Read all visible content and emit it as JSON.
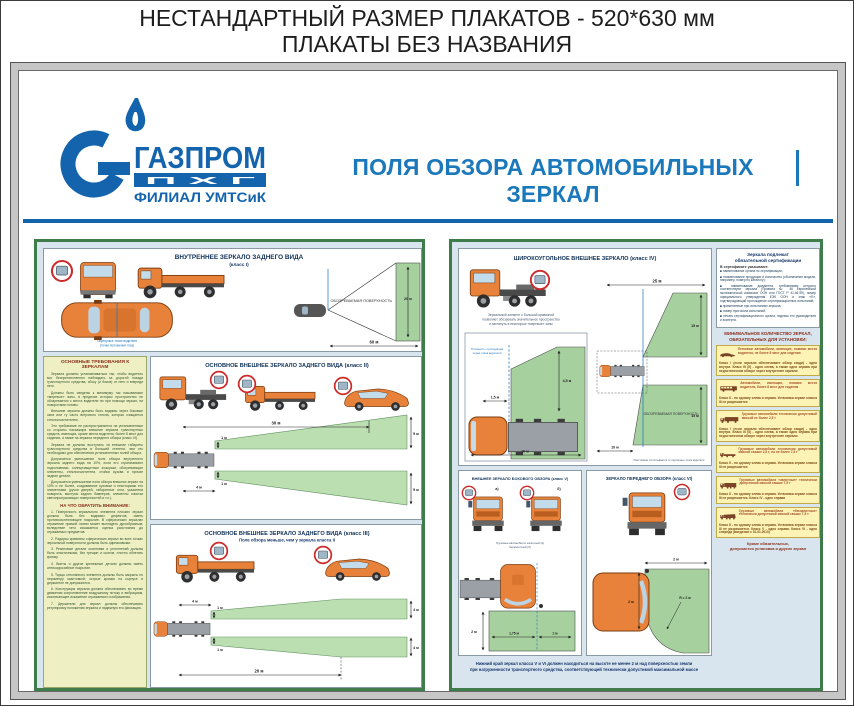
{
  "header": {
    "line1": "НЕСТАНДАРТНЫЙ РАЗМЕР ПЛАКАТОВ - 520*630 мм",
    "line2": "ПЛАКАТЫ БЕЗ НАЗВАНИЯ"
  },
  "brand": {
    "name": "ГАЗПРОМ",
    "unit": "П Х Г",
    "branch": "ФИЛИАЛ УМТСиК",
    "blue": "#1464ad"
  },
  "poster_title": "ПОЛЯ ОБЗОРА АВТОМОБИЛЬНЫХ ЗЕРКАЛ",
  "class1": {
    "title": "ВНУТРЕННЕЕ ЗЕРКАЛО ЗАДНЕГО ВИДА",
    "klass": "(класс I)",
    "surface": "ОБОЗРЕВАЕМАЯ ПОВЕРХНОСТЬ",
    "height_dim": "20 м",
    "width_dim": "60 м",
    "eye_note1": "Окулярные точки водителя",
    "eye_note2": "(точки положения глаз)"
  },
  "requirements": {
    "title": "ОСНОВНЫЕ ТРЕБОВАНИЯ К ЗЕРКАЛАМ",
    "paragraphs": [
      "Зеркала должны устанавливаться так, чтобы водитель мог беспрепятственно наблюдать за дорогой позади транспортного средства, сбоку (и боков) от него и впереди него.",
      "Должны быть сведены к минимуму так называемые «мертвые» зоны, в пределах которых пространство не обозревается с места водителя ни при помощи зеркал, ни поворотами головы.",
      "Внешние зеркала должны быть видимы через боковые окна или ту часть ветрового стекла, которая очищается стеклоочистителем.",
      "Это требование не распространяется на установленные со стороны пассажира внешние зеркала транспортных средств, имеющих, кроме места водителя, более 8 мест для сидения, а также на зеркала переднего обзора (класс VI).",
      "Зеркала не должны выступать за внешние габариты транспортного средства в большей степени, чем это необходимо для обеспечения установленных полей обзора.",
      "Допускается уменьшение поля обзора внутреннего зеркала заднего вида на 10%, если его ограничивают подголовники, солнцезащитные козырьки, обогревающие элементы, стеклоочистители, стойки кузова и прочие задние детали.",
      "Допускается уменьшение поля обзора внешних зеркал на 10% и не более, создаваемое кузовом и некоторыми его элементами (ручки дверей, габаритные огни, указатели поворота, выступы задних бамперов, элементы очистки светопропускающих поверхностей и т.п.)."
    ],
    "attention_title": "НА ЧТО ОБРАТИТЬ ВНИМАНИЕ:",
    "attention_items": [
      "1. Поверхность зеркального элемента плоских зеркал должна быть без видимых дефектов, иметь противоослепляющее покрытие. В сферических зеркалах отражение прямой линии может выглядеть дугообразным, вследствие чего искажается оценка расстояния до отражаемых предметов.",
      "2. Радиусы кривизны сферических зеркал во всех точках зеркальной поверхности должны быть одинаковыми.",
      "3. Резиновые детали окантовки и уплотнений должны быть эластичными, без трещин и сколов, плотно облегать кромку.",
      "4. Винты и другие крепежные детали должны иметь антикоррозийное покрытие.",
      "5. Торцы стеклянного элемента должны быть закрыты по периметру окантовкой; острые кромки на корпусе и держателе не допускаются.",
      "6. Конструкция зеркала должна обеспечивать во время движения сопротивление воздушному потоку и вибрациям, исключающее искажение отражаемого изображения.",
      "7. Держатели для зеркал должны обеспечивать регулировку положения зеркала и надежную его фиксацию."
    ]
  },
  "class2": {
    "title": "ОСНОВНОЕ ВНЕШНЕЕ ЗЕРКАЛО ЗАДНЕГО ВИДА (класс II)",
    "dims": {
      "length": "30 м",
      "far_top": "5 м",
      "far_bottom": "5 м",
      "near_top": "1 м",
      "near_bottom": "1 м",
      "offset": "4 м"
    }
  },
  "class3": {
    "title": "ОСНОВНОЕ ВНЕШНЕЕ ЗЕРКАЛО ЗАДНЕГО ВИДА (класс III)",
    "subtitle": "Поле обзора меньше, чем у зеркала класса II",
    "dims": {
      "offset": "4 м",
      "near_top": "1 м",
      "near_bottom": "1 м",
      "far_top": "4 м",
      "far_bottom": "4 м",
      "length": "20 м"
    }
  },
  "class4": {
    "title": "ШИРОКОУГОЛЬНОЕ ВНЕШНЕЕ ЗЕРКАЛО (класс IV)",
    "caption1": "Зеркальный элемент с большой кривизной",
    "caption2": "позволяет обозревать значительное пространство",
    "caption3": "и заглянуть в некоторые «мертвые» зоны",
    "inset": {
      "plane1": "Плоскость, проходящая",
      "plane2": "через глаза водителя",
      "h": "4,5 м",
      "w": "1,5 м",
      "len": "10 м"
    },
    "main": {
      "length": "25 м",
      "top": "15 м",
      "bottom": "15 м",
      "near": "10 м",
      "surface": "ОБОЗРЕВАЕМАЯ ПОВЕРХНОСТЬ",
      "note": "Расстояние отсчитывается от окулярных точек водителя"
    }
  },
  "class5": {
    "title": "ВНЕШНЕЕ ЗЕРКАЛО БОКОВОГО ОБЗОРА (класс V)",
    "label_a": "а)",
    "label_b": "б)",
    "caption1": "Грузовые автомобили: капотный (а)",
    "caption2": "бескапотный (б)",
    "dims": {
      "h": "2 м",
      "w1": "1,75 м",
      "w2": "1 м"
    }
  },
  "class6": {
    "title": "ЗЕРКАЛО ПЕРЕДНЕГО ОБЗОРА (класс VI)",
    "dims": {
      "front": "2 м",
      "h": "2 м",
      "r": "R = 2 м"
    }
  },
  "bottom_note1": "Нижний край зеркал класса V и VI должен находиться на высоте не менее 2 м над поверхностью земли",
  "bottom_note2": "при нагруженности транспортного средства, соответствующей технически допустимой максимальной массе",
  "certification": {
    "title1": "Зеркала подлежат",
    "title2": "обязательной сертификации",
    "intro": "В сертификате указывают:",
    "items": [
      "■ наименование органа по сертификации;",
      "■ наименование продукции и количество (обозначение модели, например, номер по каталогу);",
      "■ наименование документа, требованиям которого соответствуют зеркала (Правила № 46 Европейской экономической комиссии ООН или ГОСТ Р 41.46-99), номер официального утверждения ЕЭК ООН и знак «Е», подтверждающий прохождение сертификационных испытаний;",
      "■ примененные при испытаниях зеркала;",
      "■ номер протокола испытаний;",
      "■ печать сертификационного органа, подпись его руководителя и эксперта."
    ]
  },
  "minimum": {
    "title": "МИНИМАЛЬНОЕ КОЛИЧЕСТВО ЗЕРКАЛ, ОБЯЗАТЕЛЬНЫХ ДЛЯ УСТАНОВКИ:",
    "cards": [
      {
        "icon": "car-side-icon",
        "desc": "Легковые автомобили, имеющие, помимо места водителя, не более 8 мест для сидения",
        "classes": "Класс I (если зеркало обеспечивает обзор сзади) - одно внутри. Класс III (II) - одно слева, а также одно справа при недостаточном обзоре через внутреннее зеркало"
      },
      {
        "icon": "bus-side-icon",
        "desc": "Автомобили, имеющие, помимо места водителя, более 8 мест для сидения",
        "classes": "Класс II - по одному слева и справа. Установка зеркал класса III не разрешается"
      },
      {
        "icon": "light-truck-icon",
        "desc": "Грузовые автомобили технически допустимой массой не более 2,5 т",
        "classes": "Класс I (если зеркало обеспечивает обзор сзади) - одно внутри. Класс III (II) - одно слева, а также одно справа при недостаточном обзоре через внутреннее зеркало"
      },
      {
        "icon": "truck-icon",
        "desc": "Грузовые автомобили технически допустимой массой свыше 2,5 т, но не более 7,5 т",
        "classes": "Класс II - по одному слева и справа. Установка зеркал класса III не разрешается"
      },
      {
        "icon": "heavy-truck-icon",
        "desc": "Грузовые автомобили «капотные» технически допустимой массой свыше 7,5 т",
        "classes": "Класс II - по одному слева и справа. Установка зеркал класса III не разрешается. Класс IV - одно справа"
      },
      {
        "icon": "cabover-truck-icon",
        "desc": "Грузовые автомобили «бескапотные» технически допустимой массой свыше 7,5 т",
        "classes": "Класс II - по одному слева и справа. Установка зеркал класса III не разрешается. Класс V - одно справа. Класс VI - одно спереди (введение с 01.01.2010)"
      }
    ],
    "footer1": "Кроме обязательных,",
    "footer2": "допускается установка и других зеркал"
  }
}
